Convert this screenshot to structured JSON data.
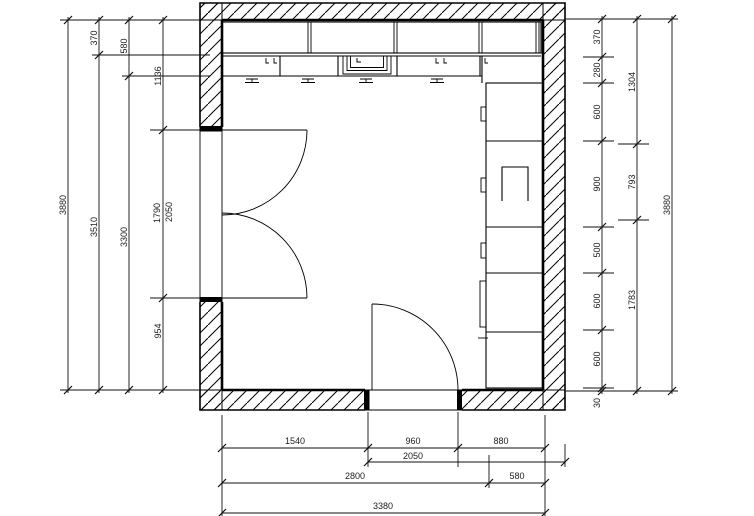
{
  "plan": {
    "left_dims": {
      "total": "3880",
      "upper_cabinet_depth": "370",
      "remainder_1": "3510",
      "base_cabinet_depth": "580",
      "remainder_2": "3300",
      "door_offset_top": "1136",
      "door_opening": "1790",
      "door_opening_frame": "2050",
      "door_offset_bottom": "954"
    },
    "right_dims": {
      "segments": [
        "370",
        "280",
        "600",
        "900",
        "500",
        "600",
        "600",
        "30"
      ],
      "zones": [
        "1304",
        "793",
        "1783"
      ],
      "total": "3880"
    },
    "bottom_dims": {
      "segments": [
        "1540",
        "960",
        "880"
      ],
      "opening_frame": "2050",
      "zones": [
        "2800",
        "580"
      ],
      "total": "3380"
    }
  }
}
